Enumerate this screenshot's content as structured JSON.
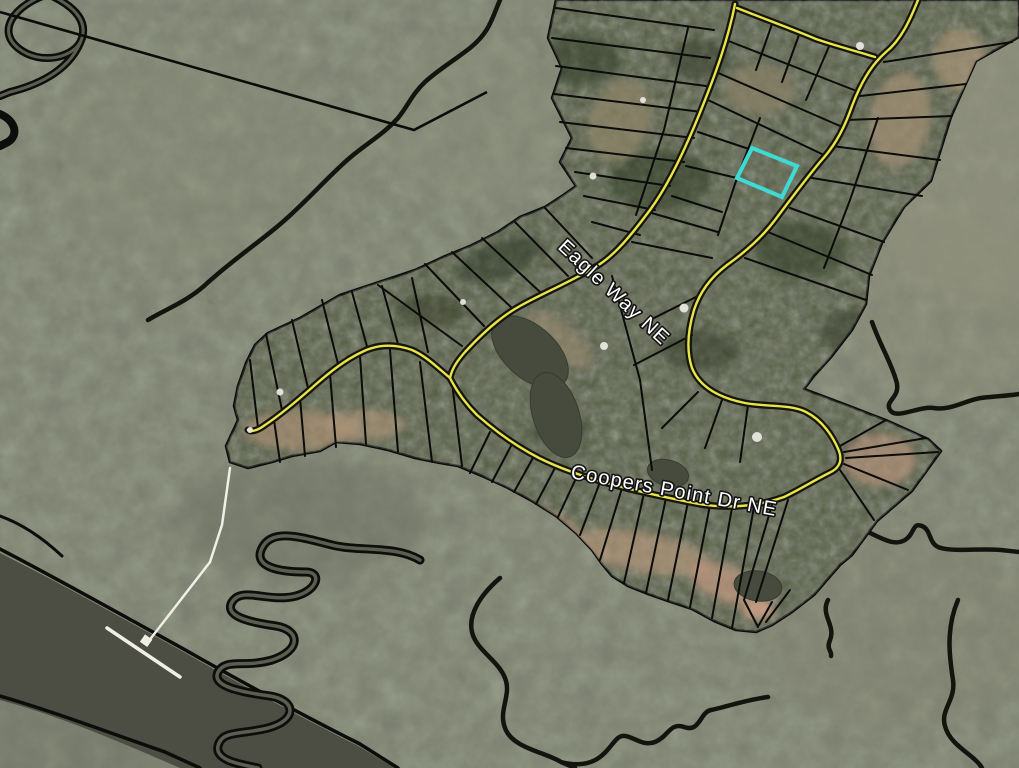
{
  "map": {
    "kind": "aerial-parcel-map",
    "road_labels": {
      "eagle_way": "Eagle Way NE",
      "coopers_point": "Coopers Point Dr NE"
    },
    "highlight": {
      "color": "#3EDAD4"
    },
    "colors": {
      "marsh": "#7B8070",
      "river_water": "#4C4D43",
      "pond_water": "#474B3D",
      "forest": "#555D44",
      "road_fill": "#E9E448",
      "road_casing": "#151510",
      "parcel_line": "#0B0B09",
      "creek_line": "#0D0D0B",
      "dock": "#F0EFE6",
      "label_fill": "#FFFFFF",
      "label_outline": "#141414"
    },
    "features": [
      "marsh",
      "tidal-creeks",
      "river",
      "subdivision-parcels",
      "roads",
      "ponds",
      "houses",
      "private-dock",
      "highlighted-parcel"
    ]
  }
}
